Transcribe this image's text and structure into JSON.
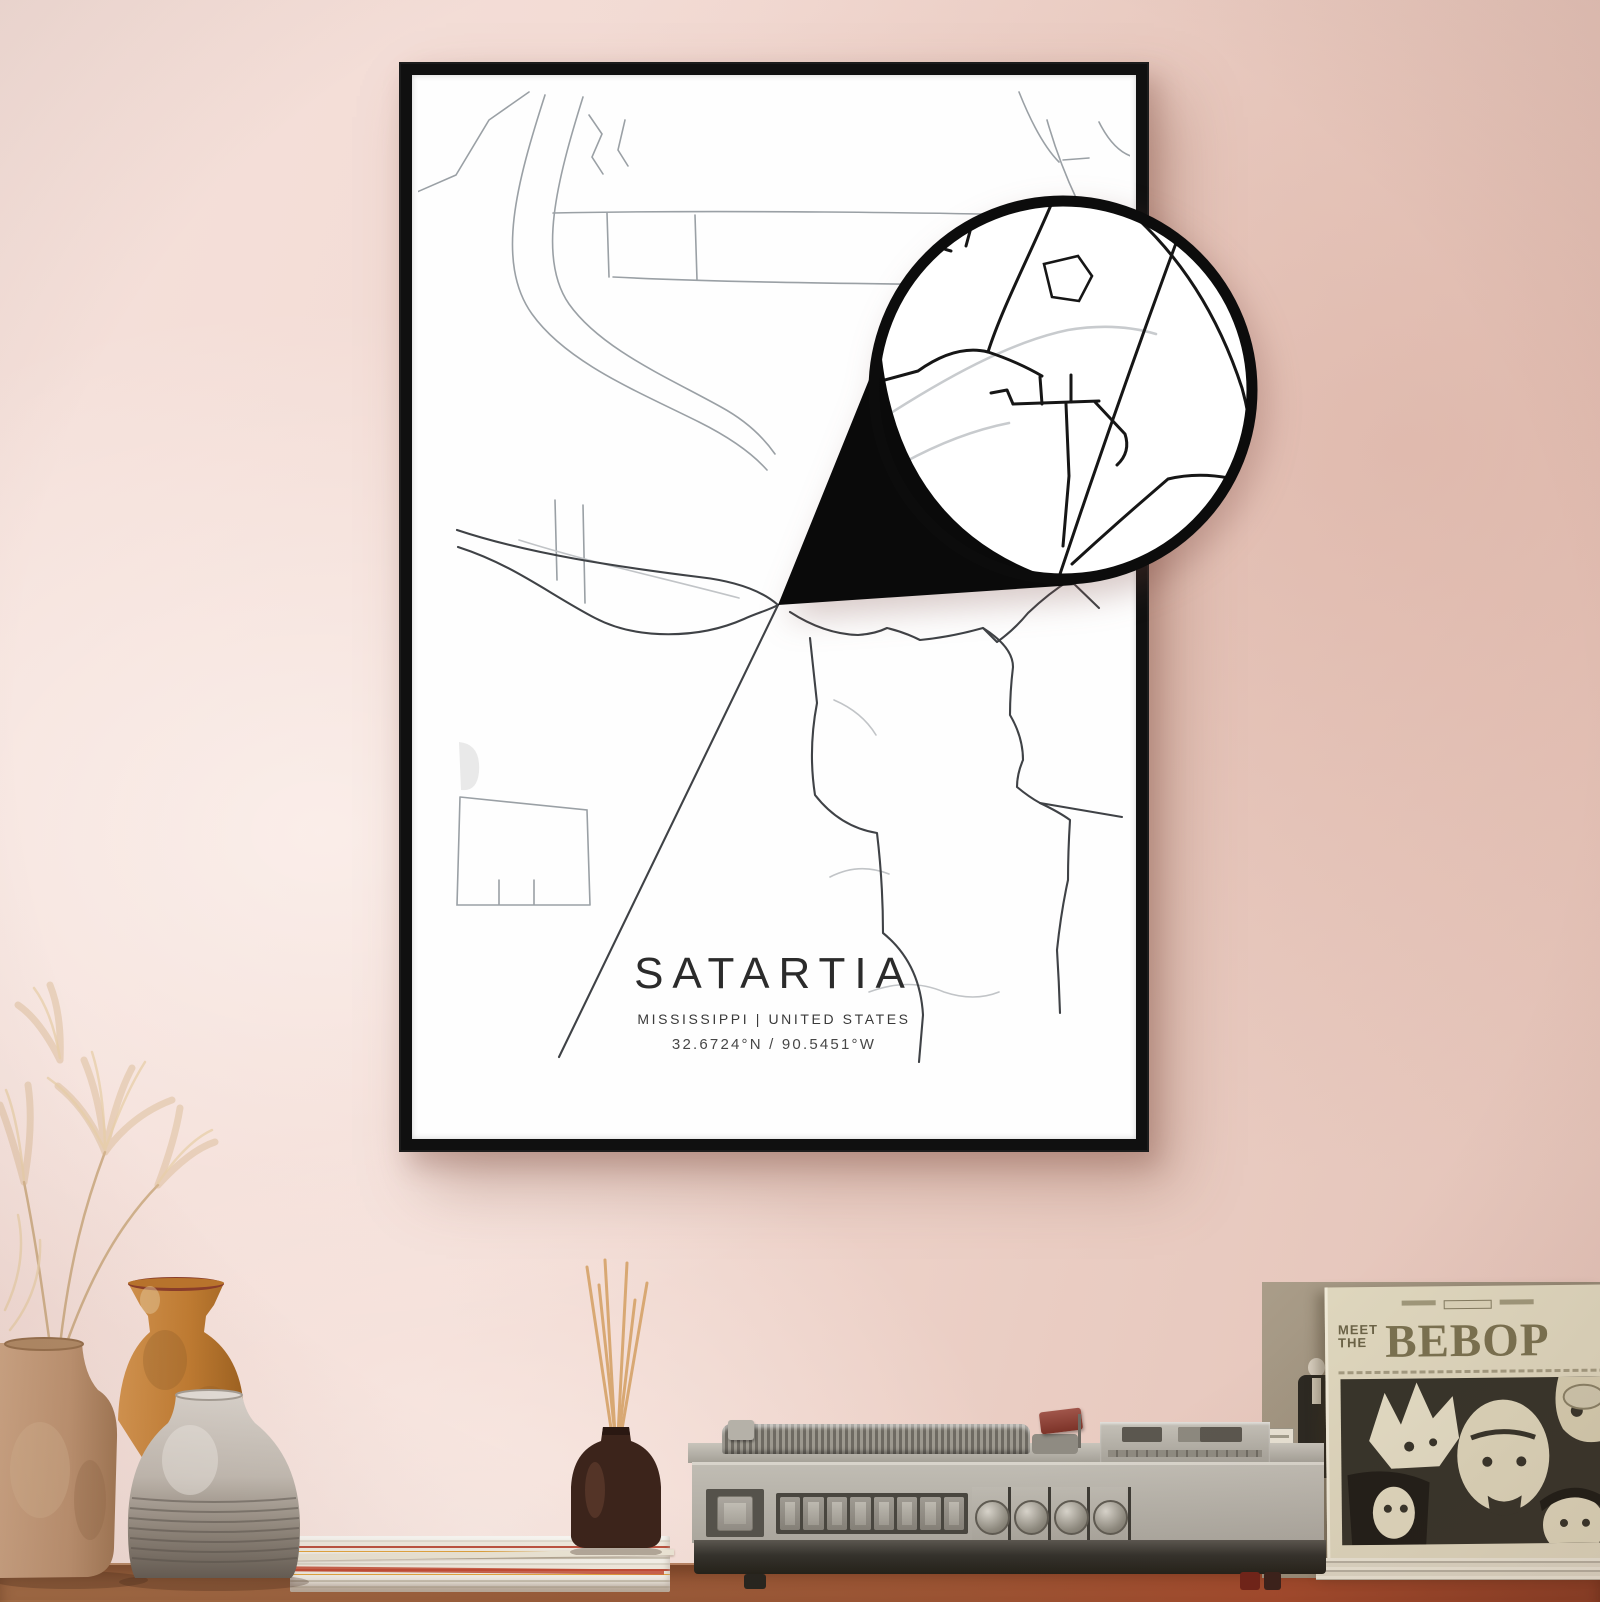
{
  "poster": {
    "title": "SATARTIA",
    "subtitle": "MISSISSIPPI | UNITED STATES",
    "coordinates": "32.6724°N / 90.5451°W"
  },
  "album": {
    "title_word1": "MEET",
    "title_word2": "THE",
    "title_main": "BEBOP"
  },
  "colors": {
    "wall_pink": "#eed3ca",
    "wall_pink_dark": "#e3c2b7",
    "frame_black": "#101010",
    "poster_white": "#fdfdfd",
    "map_line_light": "#9aa0a5",
    "map_line_dark": "#3f4246",
    "callout_black": "#0a0a0a",
    "table_wood": "#9a5a38",
    "sleeve_cream": "#ded6bd",
    "sleeve_ink": "#6b6347",
    "vase_tan": "#c09a78",
    "vase_amber": "#c8863f",
    "vase_gray": "#c2bbb2",
    "player_gray": "#b5b1a8",
    "tonearm_red": "#8e3b31"
  }
}
